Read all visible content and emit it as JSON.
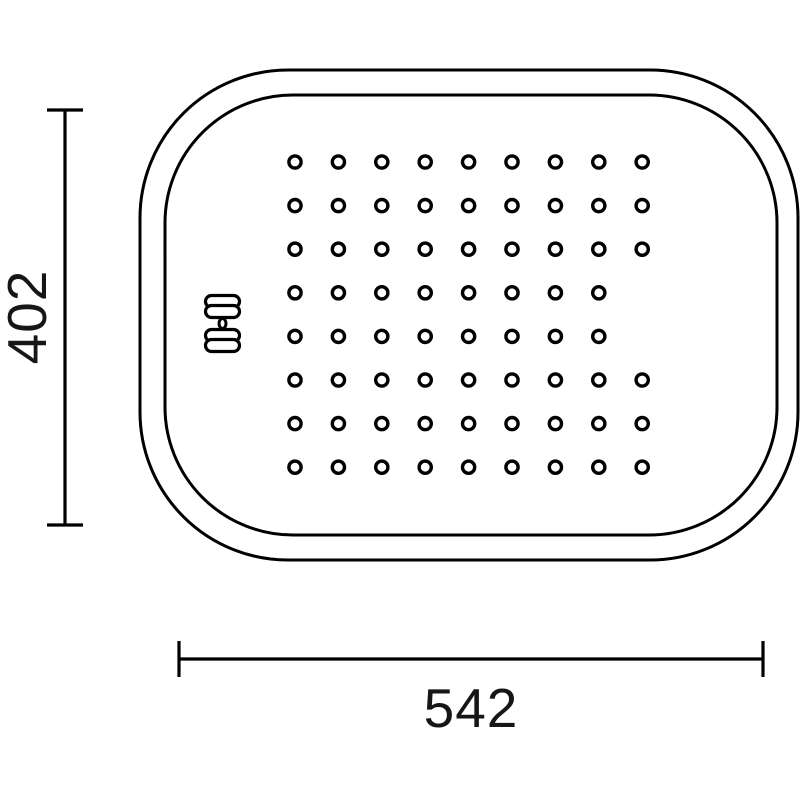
{
  "title": "perforated-tray-technical-drawing",
  "colors": {
    "background": "#ffffff",
    "line": "#000000",
    "label_text": "#161616"
  },
  "dimensions": {
    "height_label": "402",
    "width_label": "542"
  },
  "drawing": {
    "canvas": {
      "width": 800,
      "height": 800
    },
    "outer_rect": {
      "x": 140,
      "y": 70,
      "width": 658,
      "height": 490,
      "radius": 148,
      "stroke_width": 3
    },
    "inner_rect": {
      "x": 165,
      "y": 95,
      "width": 612,
      "height": 440,
      "radius": 128,
      "stroke_width": 3
    },
    "holes": {
      "rows": 8,
      "columns": 9,
      "start_x": 295,
      "start_y": 162,
      "spacing_x": 43.4,
      "spacing_y": 43.6,
      "radius": 6.1,
      "stroke_width": 3.4,
      "missing": [
        [
          4,
          9
        ],
        [
          5,
          9
        ]
      ]
    },
    "brand_mark": {
      "icon": "double-bar-emblem-icon",
      "x": 205.5,
      "width": 34,
      "bar_height": 12,
      "bar_radius": 6,
      "bar_y_positions": [
        295.5,
        305.5,
        329.5,
        339.5
      ],
      "dot": {
        "cx": 222.5,
        "cy": 323.5,
        "rx": 3.5,
        "ry": 5
      }
    },
    "dim_vertical": {
      "line_x": 65,
      "y1": 110,
      "y2": 525,
      "cap_half_width": 18,
      "label_x": 27,
      "label_y": 317,
      "label_rotation": -90
    },
    "dim_horizontal": {
      "line_y": 659,
      "x1": 179,
      "x2": 763,
      "cap_half_height": 18,
      "label_x": 471,
      "label_y": 727
    }
  }
}
